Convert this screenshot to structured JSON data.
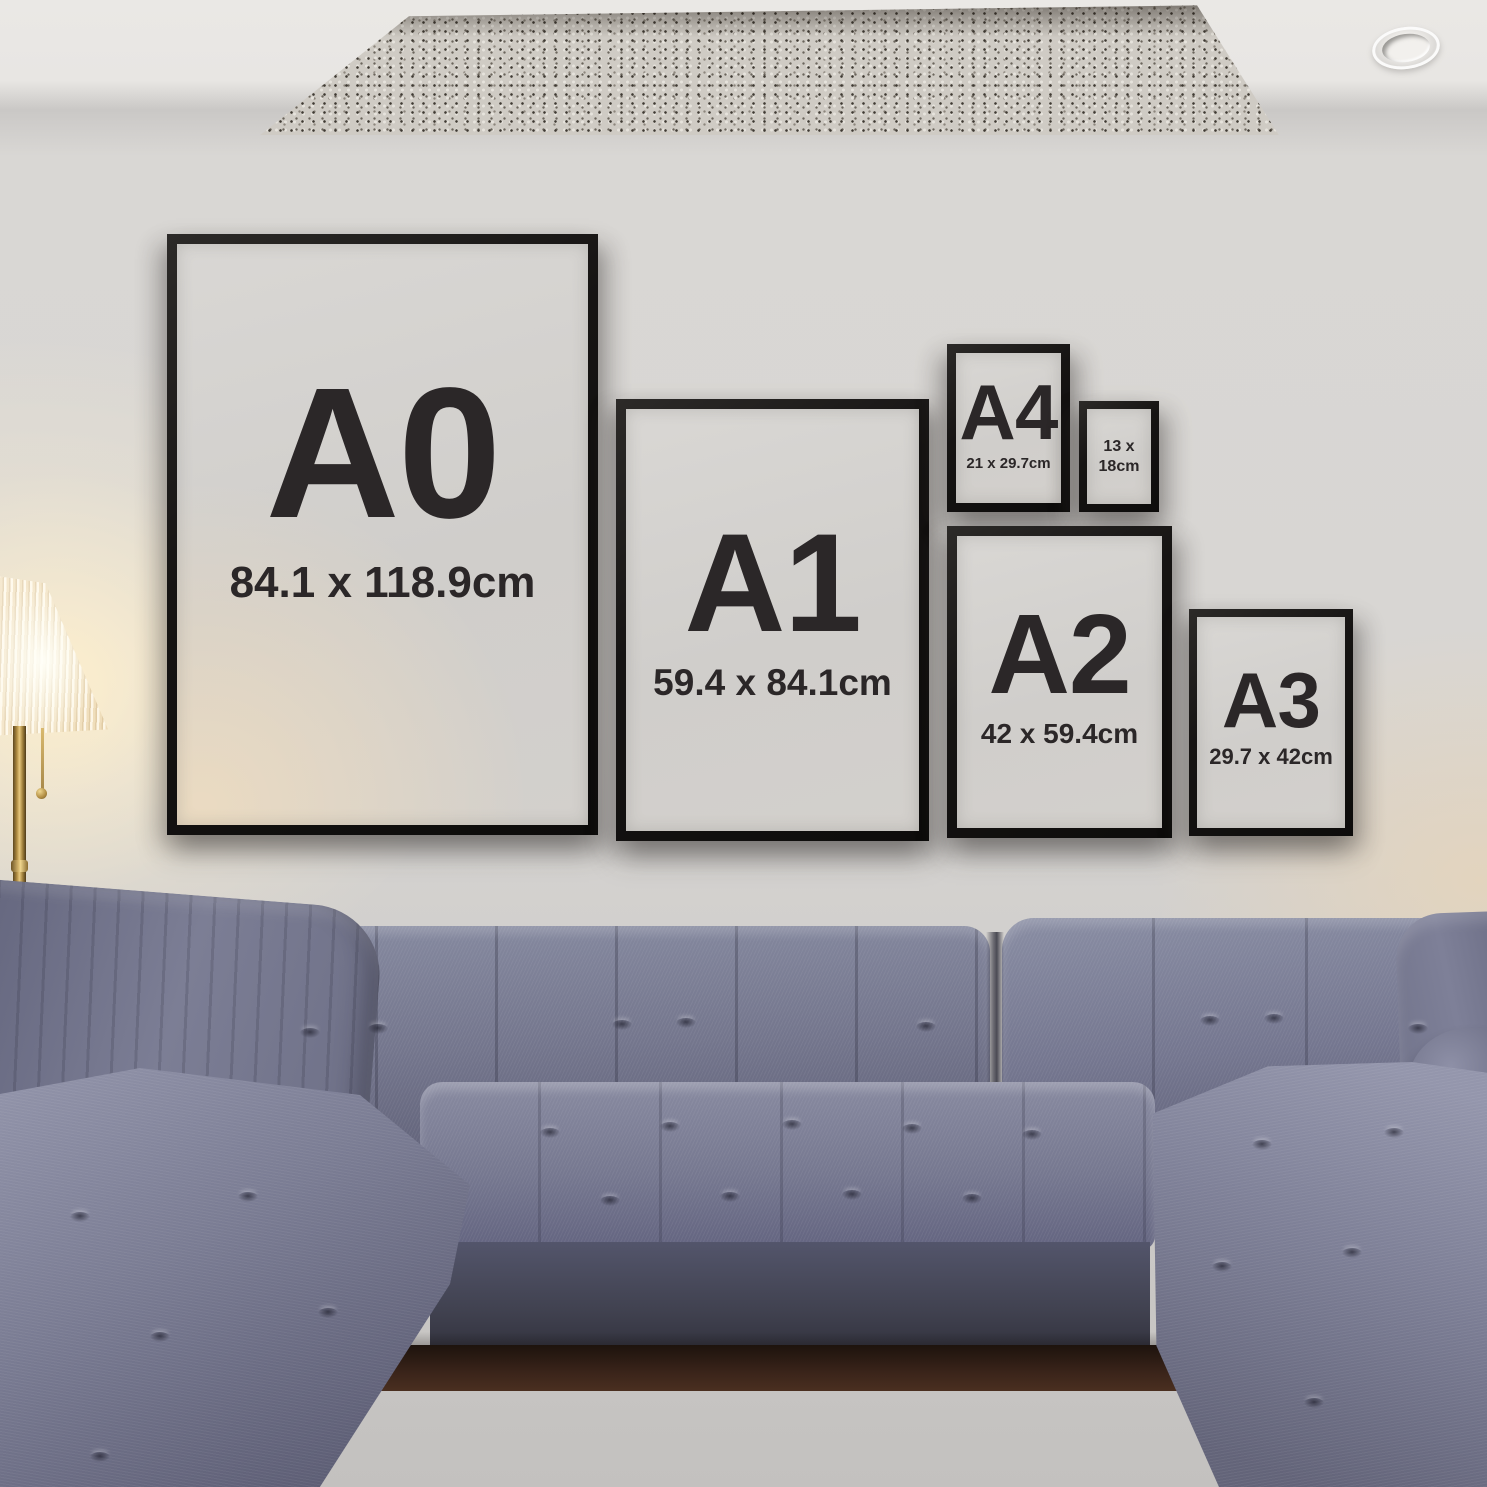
{
  "frames": [
    {
      "label": "A0",
      "dimensions": "84.1 x 118.9cm"
    },
    {
      "label": "A1",
      "dimensions": "59.4 x 84.1cm"
    },
    {
      "label": "A4",
      "dimensions": "21 x 29.7cm"
    },
    {
      "label": "",
      "dimensions": "13 x\n18cm"
    },
    {
      "label": "A2",
      "dimensions": "42 x 59.4cm"
    },
    {
      "label": "A3",
      "dimensions": "29.7 x 42cm"
    }
  ],
  "colors": {
    "frame_border": "#161413",
    "frame_mat": "#d2d0cd",
    "text": "#2b2728",
    "wall": "#d8d6d3",
    "ceiling": "#eae8e5",
    "sofa_fabric": "#73758c",
    "rug": "#cfcbc4",
    "lamp_glow": "#ffe9c4",
    "lamp_gold": "#b08c42",
    "floor": "#3a241a"
  }
}
